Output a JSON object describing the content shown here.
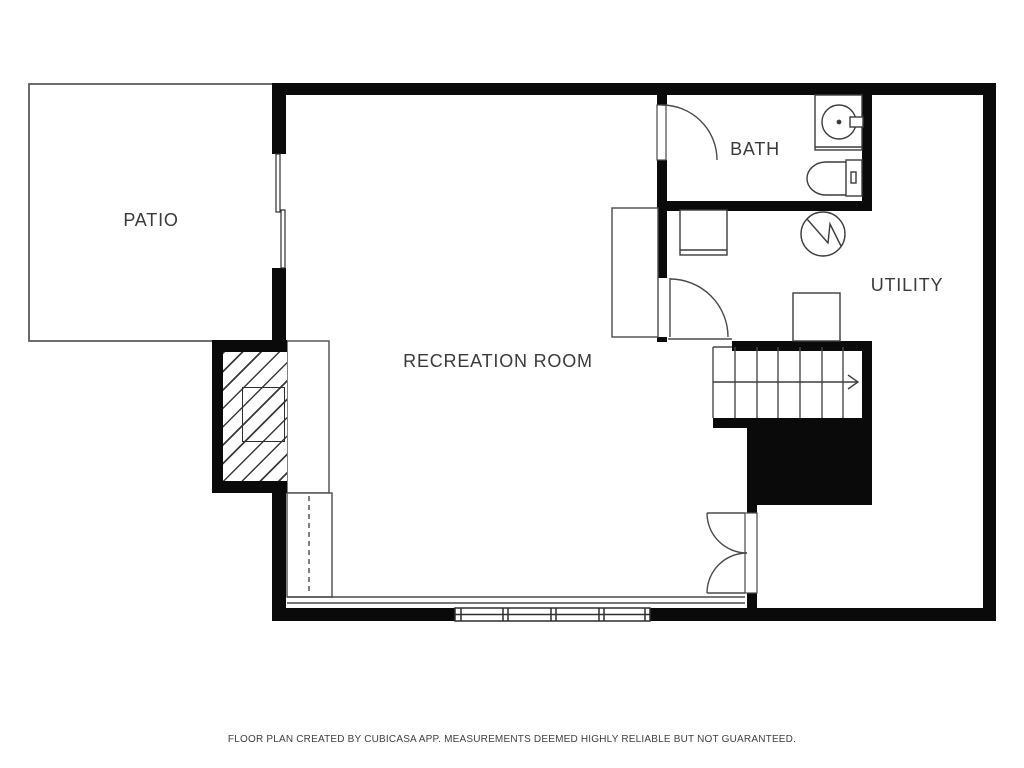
{
  "plan": {
    "title": "basement floor plan",
    "rooms": {
      "patio": {
        "label": "PATIO"
      },
      "recreation": {
        "label": "RECREATION ROOM"
      },
      "bath": {
        "label": "BATH"
      },
      "utility": {
        "label": "UTILITY"
      }
    },
    "footer": "FLOOR PLAN CREATED BY CUBICASA APP. MEASUREMENTS DEEMED HIGHLY RELIABLE BUT NOT GUARANTEED.",
    "colors": {
      "background": "#ffffff",
      "wall": "#0a0a0a",
      "thin_line": "#4a4a4a",
      "label_text": "#3a3a3a"
    },
    "symbols": [
      "fireplace-hatch-icon",
      "stairs-up-arrow-icon",
      "sink-icon",
      "toilet-icon",
      "water-heater-icon",
      "door-swing-icon",
      "double-door-icon",
      "sliding-window-icon",
      "window-icon"
    ]
  }
}
